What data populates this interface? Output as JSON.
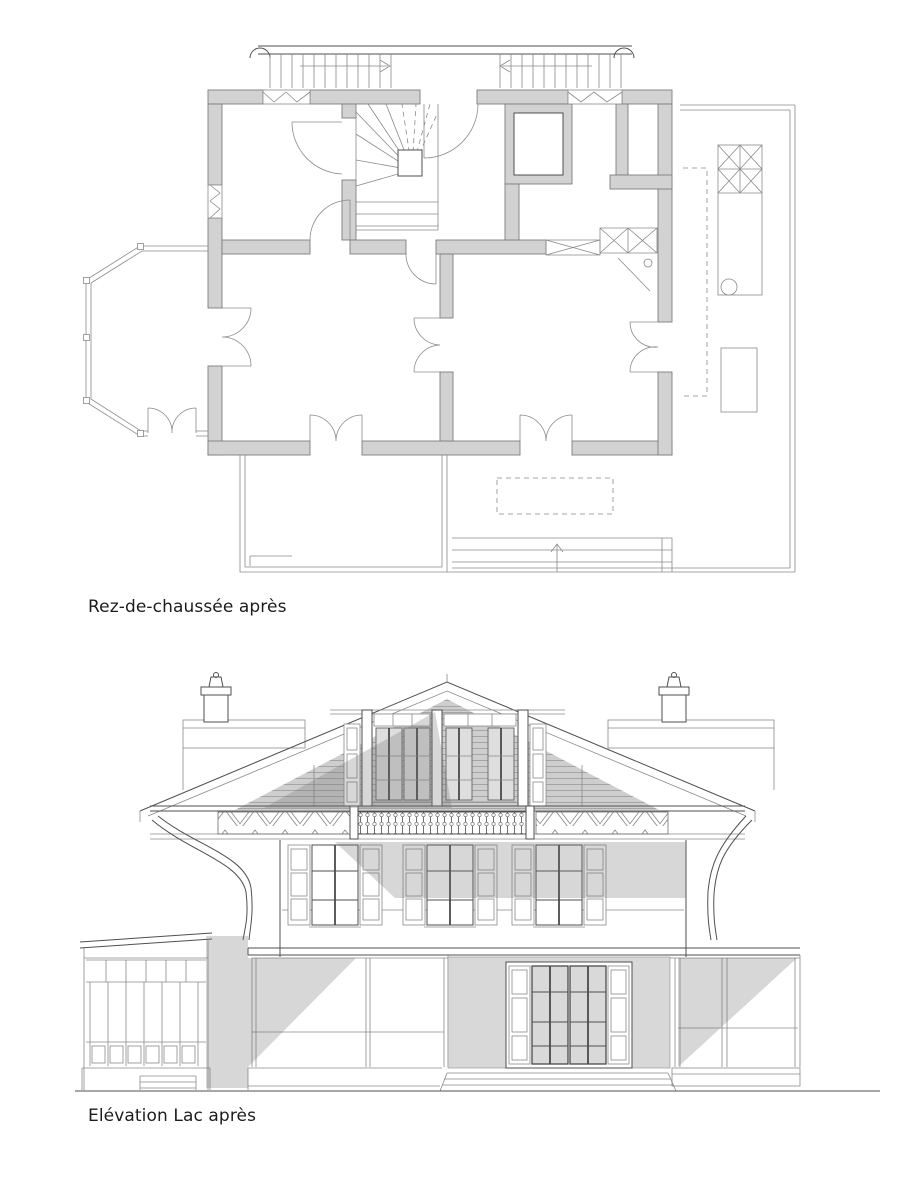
{
  "page": {
    "background": "#ffffff"
  },
  "figures": [
    {
      "id": "floor-plan",
      "caption": "Rez-de-chaussée après"
    },
    {
      "id": "elevation",
      "caption": "Elévation Lac après"
    }
  ],
  "style": {
    "colors": {
      "line": "#4f4f4f",
      "line-light": "#8a8a8a",
      "wall": "#d2d2d2",
      "wall-edge": "#7d7d7d",
      "paper": "#ffffff",
      "ink": "#1c1c1c"
    }
  }
}
